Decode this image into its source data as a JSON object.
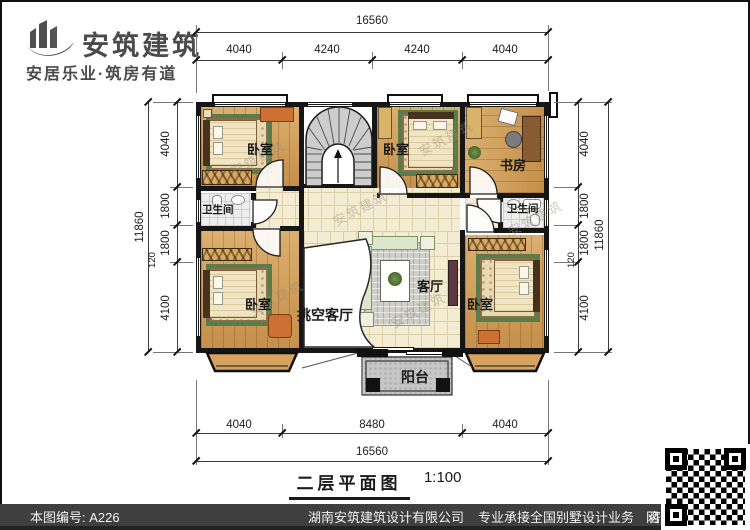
{
  "logo": {
    "name": "安筑建筑",
    "tagline": "安居乐业·筑房有道"
  },
  "plan": {
    "rooms": {
      "bedroom_tl": "卧室",
      "bedroom_tm": "卧室",
      "study": "书房",
      "bath_left": "卫生间",
      "bath_right": "卫生间",
      "bedroom_ll": "卧室",
      "void_living": "挑空客厅",
      "living": "客厅",
      "bedroom_lr": "卧室",
      "balcony": "阳台"
    },
    "watermark": "安筑建筑"
  },
  "dims": {
    "top": {
      "total": "16560",
      "segments": [
        "4040",
        "4240",
        "4240",
        "4040"
      ]
    },
    "bottom": {
      "total": "16560",
      "segments": [
        "4040",
        "8480",
        "4040"
      ]
    },
    "left": {
      "total": "11860",
      "segments": [
        "4040",
        "1800",
        "1800",
        "120",
        "4100"
      ]
    },
    "right": {
      "total": "11860",
      "segments": [
        "4040",
        "1800",
        "1800",
        "120",
        "4100"
      ]
    }
  },
  "title": {
    "text": "二层平面图",
    "scale": "1:100"
  },
  "footer": {
    "plan_number": "本图编号: A226",
    "company": "湖南安筑建筑设计有限公司",
    "service": "专业承接全国别墅设计业务",
    "phone": "咨询电话: 400-8070-511",
    "web": "网"
  },
  "colors": {
    "wall": "#161616",
    "wood_floor": "#cf9b54",
    "tile_floor": "#f3ebd2",
    "rug_green": "#597c4b",
    "balcony_gray": "#c6c6c6",
    "footer_bar": "#3f3f3f",
    "logo_gray": "#4b4b4b"
  }
}
